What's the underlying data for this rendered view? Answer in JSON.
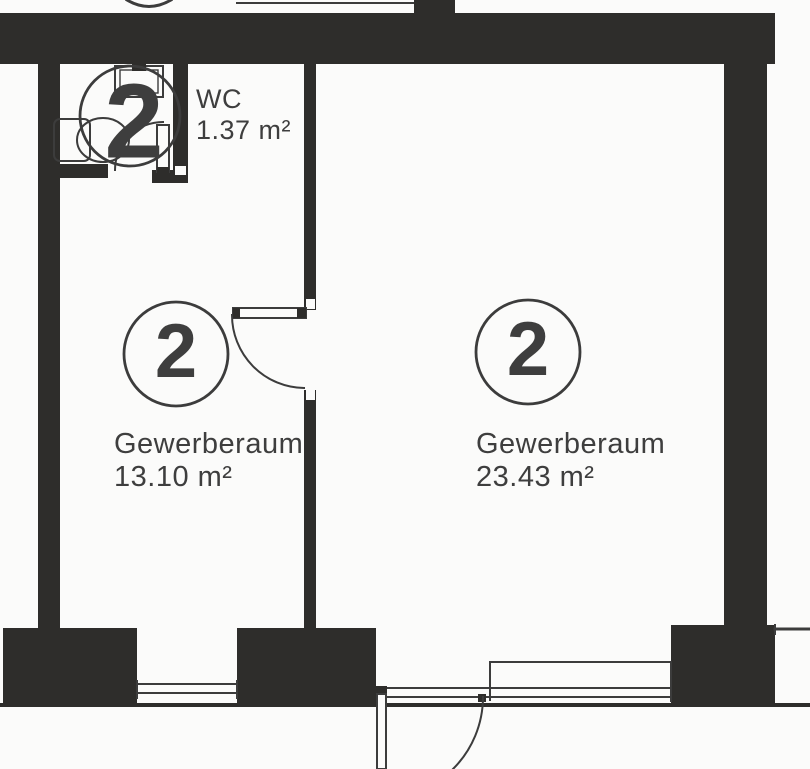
{
  "colors": {
    "wall": "#2e2d2b",
    "line": "#3c3c3c",
    "text": "#3e3e3e",
    "bg": "#fbfbfa"
  },
  "units": {
    "wc": {
      "number": "2",
      "name": "WC",
      "area": "1.37 m²"
    },
    "room_left": {
      "number": "2",
      "name": "Gewerberaum",
      "area": "13.10 m²"
    },
    "room_right": {
      "number": "2",
      "name": "Gewerberaum",
      "area": "23.43 m²"
    }
  }
}
